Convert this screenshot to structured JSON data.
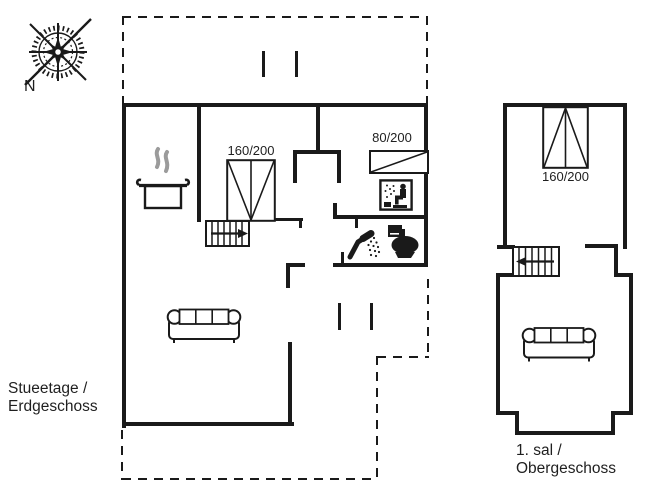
{
  "plan": {
    "compass": {
      "north_label": "N"
    },
    "ground_floor": {
      "label_line1": "Stueetage /",
      "label_line2": "Erdgeschoss",
      "double_bed_size": "160/200",
      "single_bed_size": "80/200"
    },
    "upper_floor": {
      "label_line1": "1. sal /",
      "label_line2": "Obergeschoss",
      "double_bed_size": "160/200"
    },
    "colors": {
      "line": "#1a1a1a",
      "background": "#ffffff",
      "steam": "#9b9b9b"
    },
    "icons": {
      "compass-rose-icon": "compass rose",
      "cooking-pot-icon": "kitchen / stove",
      "sauna-icon": "sauna",
      "shower-icon": "shower",
      "toilet-icon": "toilet",
      "sofa-icon": "sofa",
      "double-bed-icon": "double bed",
      "single-bed-icon": "single bed",
      "stairs-icon": "staircase with direction arrow"
    }
  }
}
